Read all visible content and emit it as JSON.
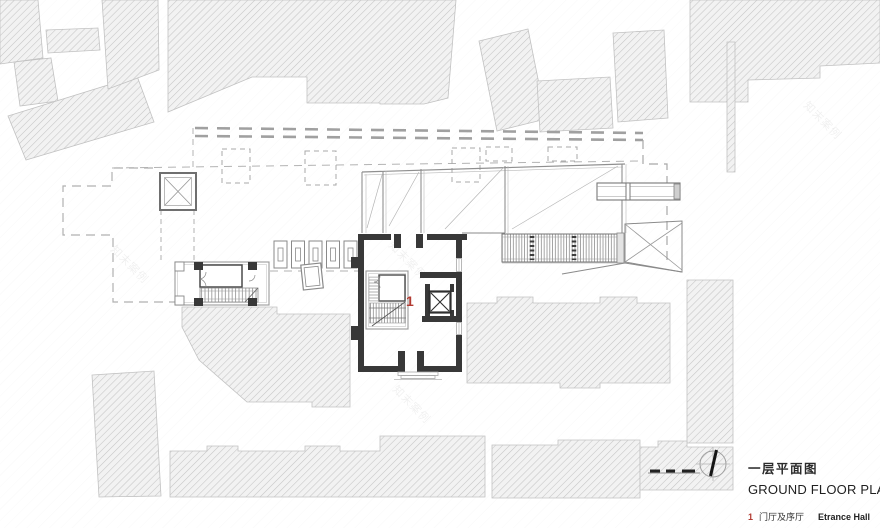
{
  "drawing": {
    "title_cn": "一层平面图",
    "title_en": "GROUND FLOOR PLAN",
    "legend": {
      "key": "1",
      "label_cn": "门厅及序厅",
      "label_en": "Etrance Hall"
    },
    "room_labels": {
      "entrance_hall": "1"
    },
    "watermark_text": "知末案例",
    "colors": {
      "wall_dark": "#383838",
      "accent_red": "#b23b32",
      "building_hatch_line": "#c5c5c5",
      "dash_gray": "#a9a9a9",
      "thin_wall_gray": "#8f8f8f"
    }
  }
}
